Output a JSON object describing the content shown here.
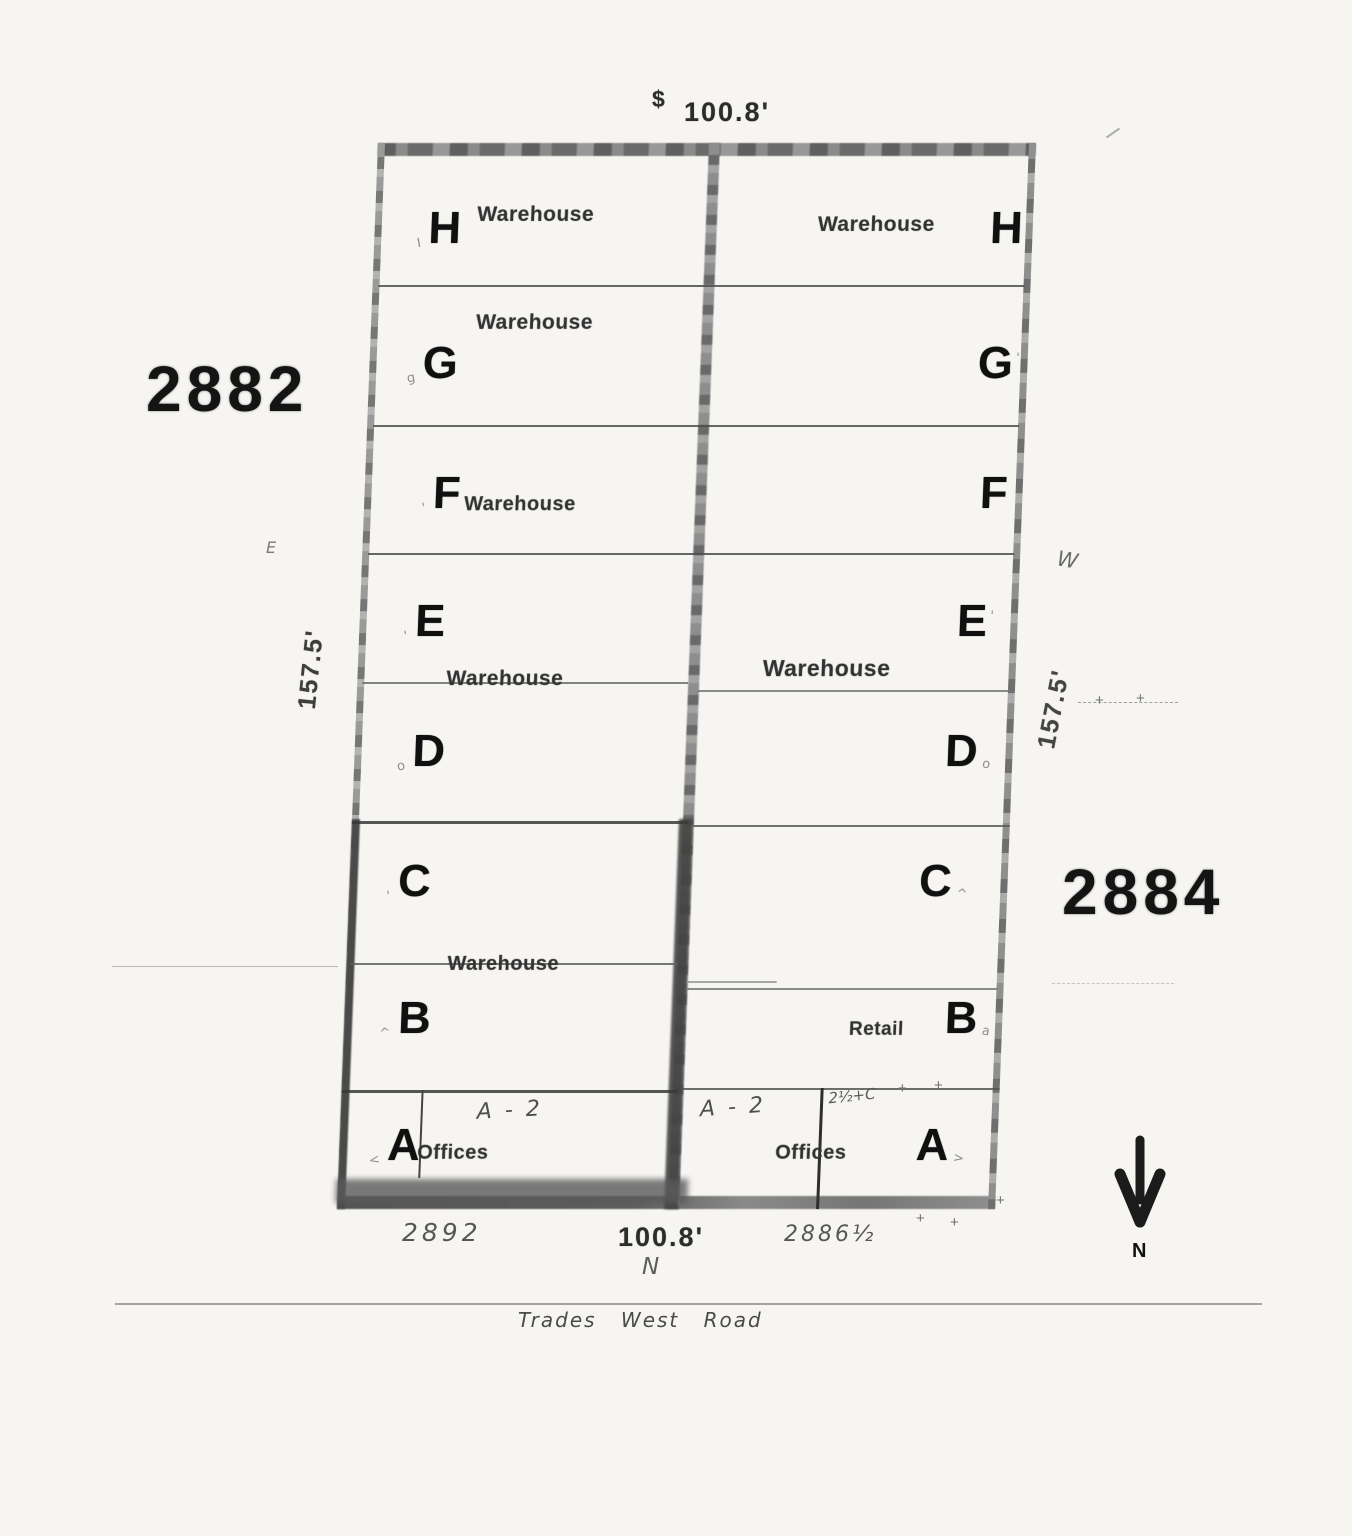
{
  "dimensions": {
    "top_prefix": "$",
    "top": "100.8'",
    "left_side": "157.5'",
    "right_side": "157.5'",
    "bottom": "100.8'"
  },
  "addresses": {
    "left_building": "2882",
    "right_building": "2884",
    "bottom_left": "2892",
    "bottom_right": "2886½"
  },
  "side_marks": {
    "left_small": "E",
    "right_w": "W",
    "bottom_n": "N"
  },
  "road": {
    "name": "Trades West Road"
  },
  "compass": {
    "label": "N"
  },
  "shared": {
    "left_ed_use": "Warehouse",
    "left_cb_use": "Warehouse",
    "right_ed_use": "Warehouse"
  },
  "annotations": {
    "left_a2": "A - 2",
    "right_a2": "A - 2",
    "right_scribble": "2½+C",
    "tick": "+"
  },
  "left_units": [
    {
      "label": "H",
      "mark": "I",
      "use": "Warehouse"
    },
    {
      "label": "G",
      "mark": "g",
      "use": "Warehouse"
    },
    {
      "label": "F",
      "mark": "'",
      "use": "Warehouse"
    },
    {
      "label": "E",
      "mark": "'"
    },
    {
      "label": "D",
      "mark": "o"
    },
    {
      "label": "C",
      "mark": "'"
    },
    {
      "label": "B",
      "mark": "^"
    },
    {
      "label": "A",
      "mark": "<",
      "use": "Offices"
    }
  ],
  "right_units": [
    {
      "label": "H",
      "use": "Warehouse"
    },
    {
      "label": "G",
      "mark": "'"
    },
    {
      "label": "F",
      "mark": ""
    },
    {
      "label": "E",
      "mark": "'"
    },
    {
      "label": "D",
      "mark": "o"
    },
    {
      "label": "C",
      "mark": "^"
    },
    {
      "label": "B",
      "mark": "a",
      "use": "Retail"
    },
    {
      "label": "A",
      "mark": ">",
      "use": "Offices"
    }
  ]
}
